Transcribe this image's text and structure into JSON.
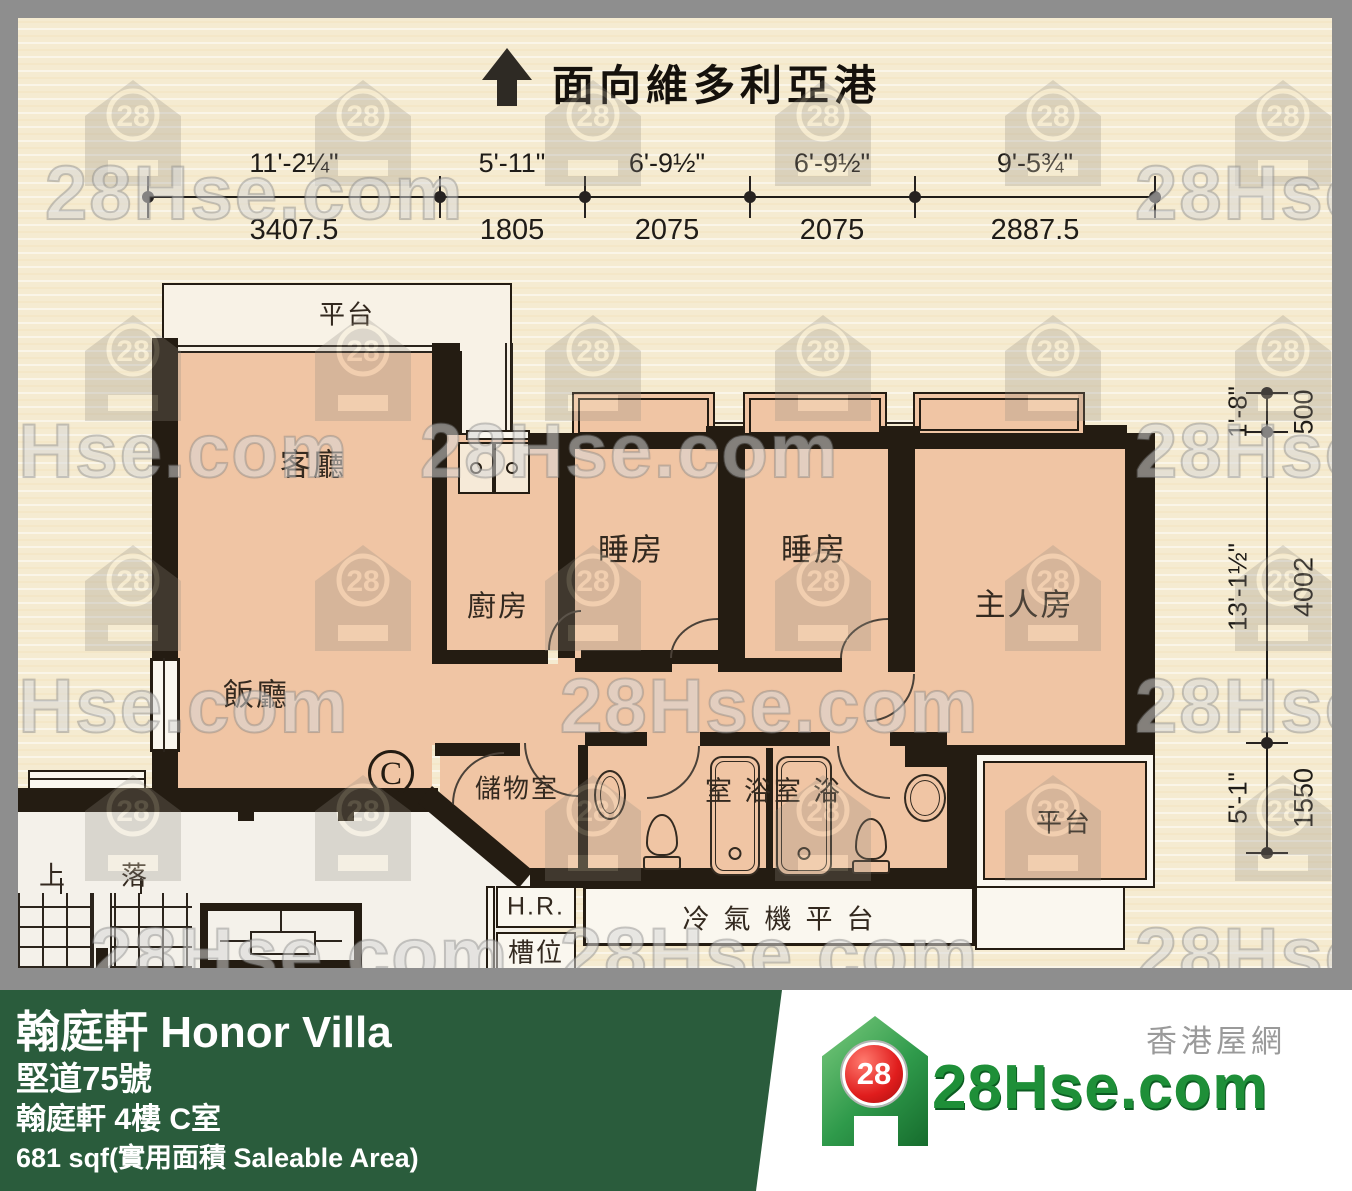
{
  "orientation": {
    "label": "面向維多利亞港"
  },
  "dim_top": [
    {
      "ft": "11'-2¼\"",
      "mm": "3407.5"
    },
    {
      "ft": "5'-11\"",
      "mm": "1805"
    },
    {
      "ft": "6'-9½\"",
      "mm": "2075"
    },
    {
      "ft": "6'-9½\"",
      "mm": "2075"
    },
    {
      "ft": "9'-5¾\"",
      "mm": "2887.5"
    }
  ],
  "dim_right": [
    {
      "ft": "1'-8\"",
      "mm": "500"
    },
    {
      "ft": "13'-1½\"",
      "mm": "4002"
    },
    {
      "ft": "5'-1\"",
      "mm": "1550"
    }
  ],
  "rooms": {
    "terrace_top": "平台",
    "living": "客廳",
    "dining": "飯廳",
    "kitchen": "廚房",
    "bedroom1": "睡房",
    "bedroom2": "睡房",
    "master": "主人房",
    "storage": "儲物室",
    "bath1": "浴室",
    "bath2": "浴室",
    "terrace_br": "平台",
    "ac_platform": "冷氣機平台",
    "hr": "H.R.",
    "duct": "槽位",
    "stairs_up": "上",
    "stairs_down": "落",
    "unit": "C"
  },
  "footer": {
    "title": "翰庭軒 Honor Villa",
    "address": "堅道75號",
    "unit_info": "翰庭軒 4樓 C室",
    "area": "681 sqf(實用面積 Saleable Area)"
  },
  "logo": {
    "badge": "28",
    "brand": "28Hse.com",
    "tagline": "香港屋網"
  },
  "watermark": {
    "text": "28Hse.com",
    "badge": "28"
  }
}
